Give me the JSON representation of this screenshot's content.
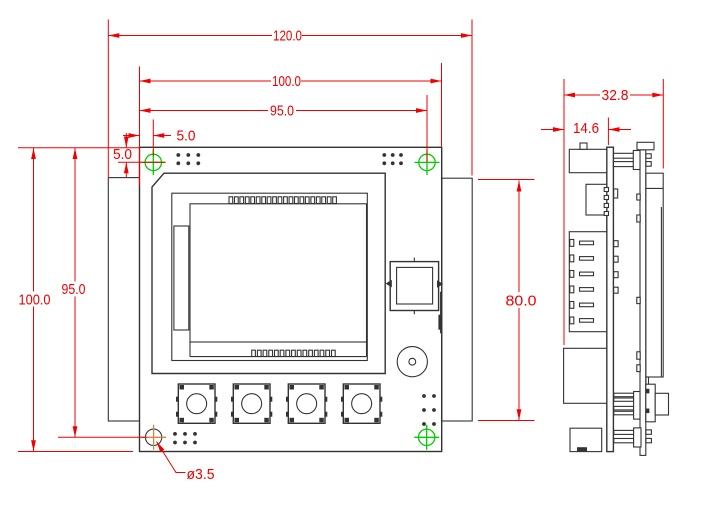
{
  "dim_labels": {
    "overall_width": "120.0",
    "board_width": "100.0",
    "hole_span_x": "95.0",
    "hole_offset_x": "5.0",
    "hole_offset_y": "5.0",
    "board_height": "100.0",
    "hole_span_y": "95.0",
    "side_tab_height": "80.0",
    "overall_depth": "32.8",
    "rear_depth": "14.6",
    "hole_diameter": "ø3.5"
  },
  "colors": {
    "dimension_red": "#f20000",
    "drawing_ink": "#333333",
    "hole_green": "#00cc00",
    "hole_orange": "#cd853f",
    "background": "#ffffff"
  }
}
